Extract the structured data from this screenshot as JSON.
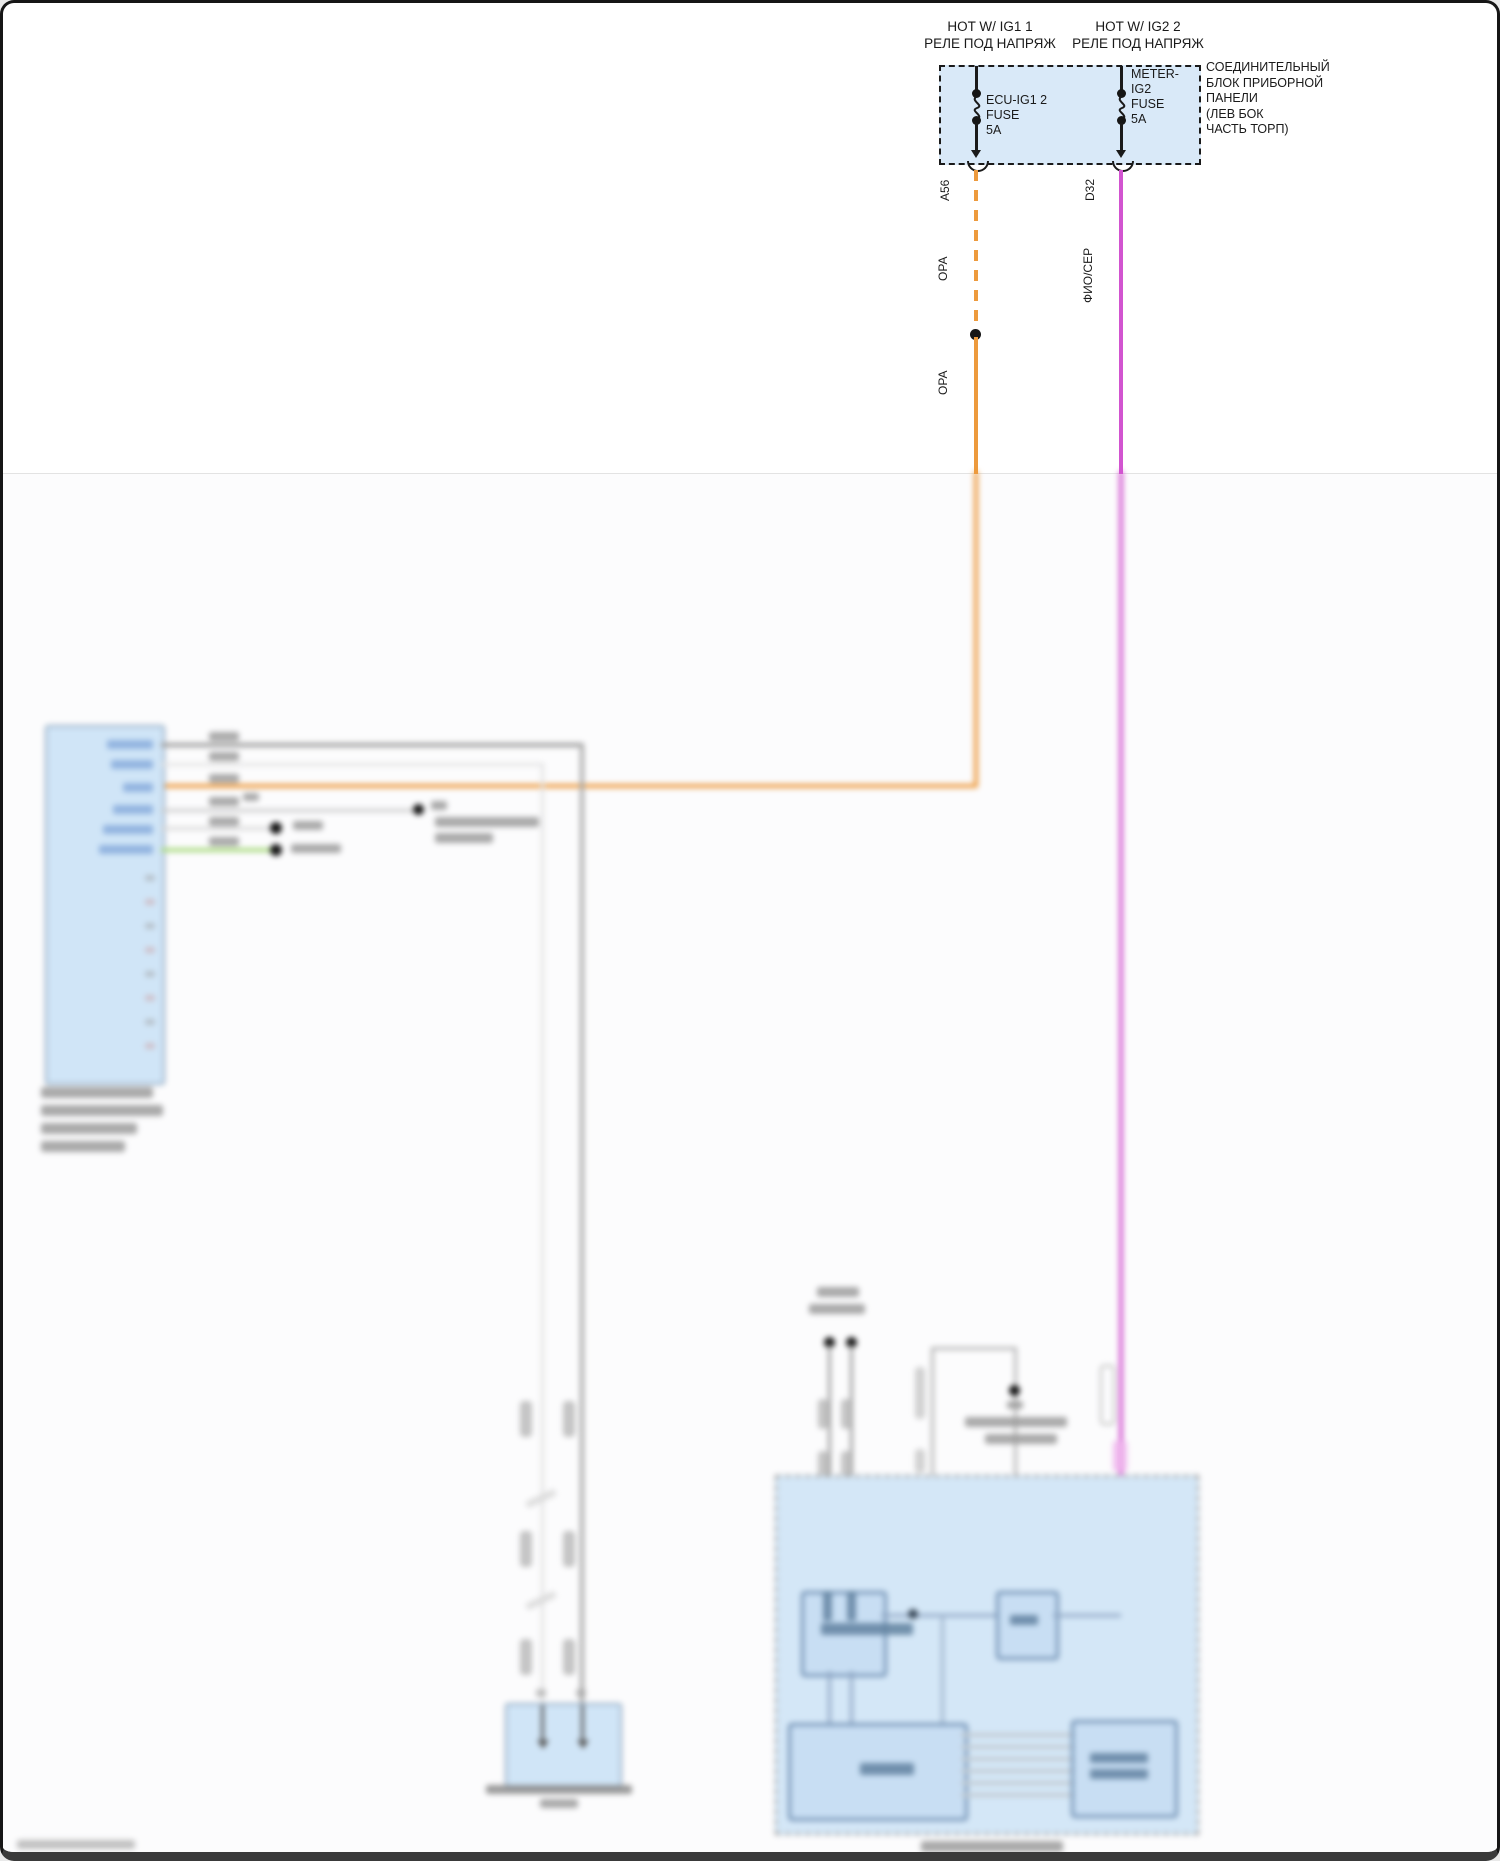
{
  "diagram": {
    "power_left": {
      "l1": "HOT W/ IG1 1",
      "l2": "РЕЛЕ ПОД НАПРЯЖ"
    },
    "power_right": {
      "l1": "HOT W/ IG2 2",
      "l2": "РЕЛЕ ПОД НАПРЯЖ"
    },
    "junction_box": {
      "fuse_left": {
        "l1": "ECU-IG1 2",
        "l2": "FUSE",
        "l3": "5A"
      },
      "fuse_right": {
        "l1": "METER-",
        "l2": "IG2",
        "l3": "FUSE",
        "l4": "5A"
      },
      "label": {
        "l1": "СОЕДИНИТЕЛЬНЫЙ",
        "l2": "БЛОК ПРИБОРНОЙ",
        "l3": "ПАНЕЛИ",
        "l4": "(ЛЕВ БОК",
        "l5": "ЧАСТЬ ТОРП)"
      }
    },
    "branch_left": {
      "pin": "A56",
      "wire_label_upper": "ОРА",
      "wire_label_lower": "ОРА"
    },
    "branch_right": {
      "pin": "D32",
      "wire_label": "ФИО/СЕР"
    },
    "colors": {
      "box_fill": "#d9e9f8",
      "wire_orange": "#ed9a3d",
      "wire_magenta": "#d254d0",
      "wire_green": "#a8da7e",
      "wire_gray": "#9b9b9b",
      "line": "#1a1a1a"
    }
  }
}
